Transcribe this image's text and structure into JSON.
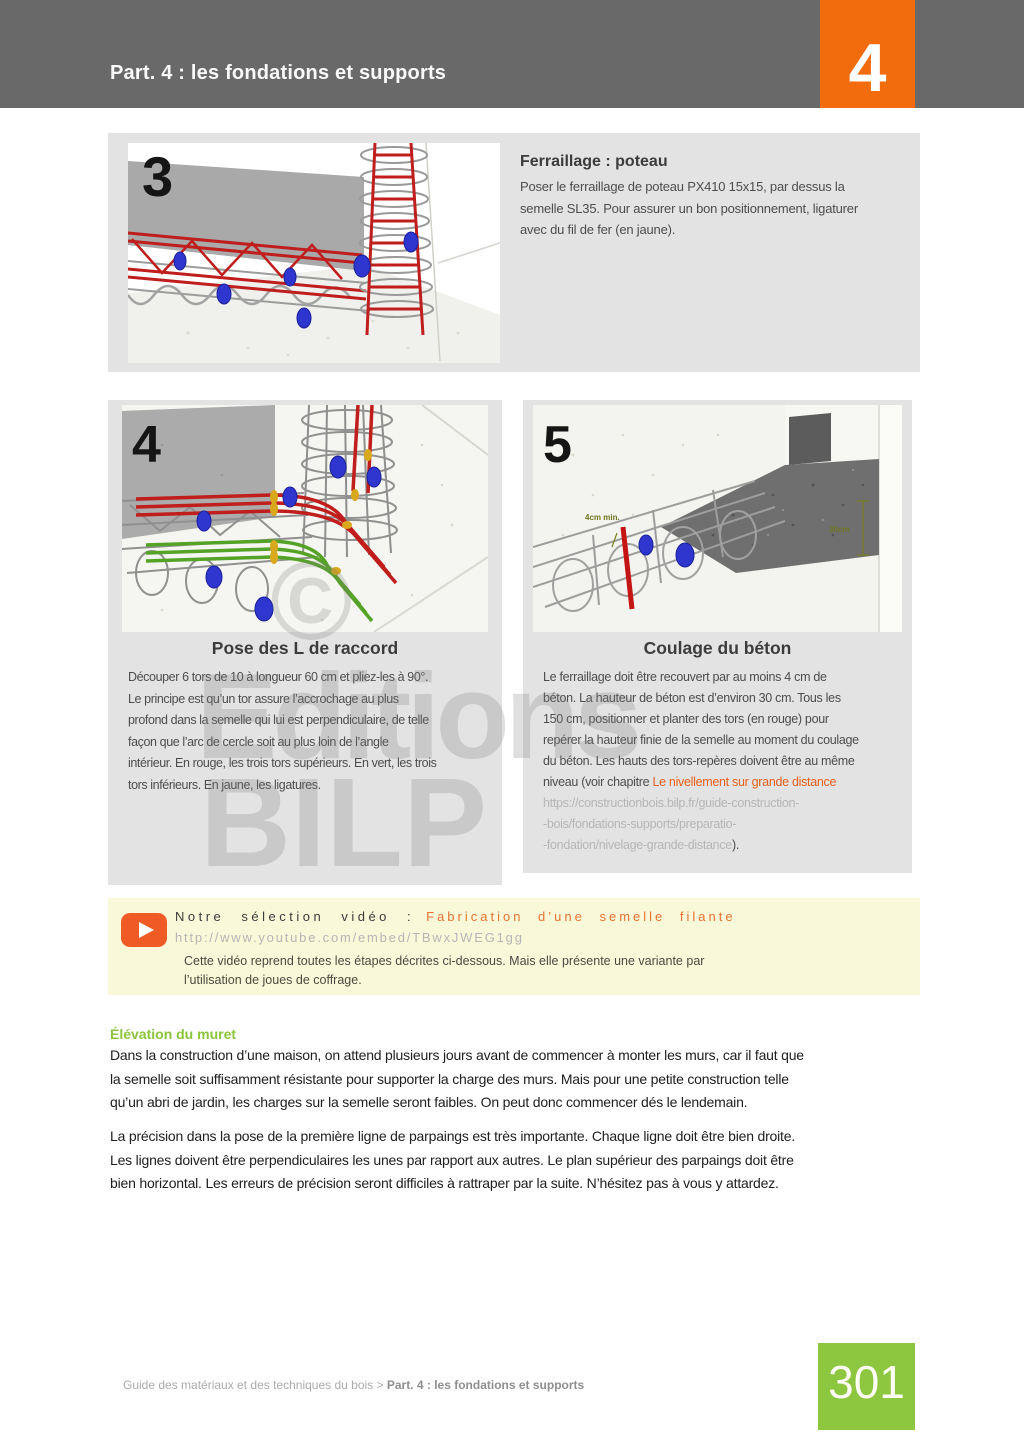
{
  "header": {
    "title": "Part. 4 : les fondations et supports",
    "chapter_number": "4"
  },
  "watermark": {
    "copyright": "©",
    "line1": "Editions",
    "line2": "BILP"
  },
  "step3": {
    "number": "3",
    "heading": "Ferraillage : poteau",
    "lines": [
      "Poser le ferraillage de poteau PX410 15x15, par dessus la",
      "semelle SL35. Pour assurer un bon positionnement, ligaturer",
      "avec du fil de fer (en jaune)."
    ]
  },
  "step4": {
    "number": "4",
    "caption": "Pose des L de raccord",
    "lines": [
      "Découper 6 tors de 10 à longueur 60 cm et pliez-les à 90°.",
      "Le principe est qu’un tor assure l’accrochage au plus",
      "profond dans la semelle qui lui est perpendiculaire, de telle",
      "façon que l’arc de cercle soit au plus loin de l’angle",
      "intérieur. En rouge, les trois tors supérieurs. En vert, les trois",
      "tors inférieurs. En jaune, les ligatures."
    ]
  },
  "step5": {
    "number": "5",
    "caption": "Coulage du béton",
    "annotation_4cm": "4cm min.",
    "annotation_30cm": "30cm",
    "lines": [
      "Le ferraillage doit être recouvert par au moins 4 cm de",
      "béton. La hauteur de béton est d’environ 30 cm. Tous les",
      "150 cm, positionner et planter des tors (en rouge) pour",
      "repérer la hauteur finie de la semelle au moment du coulage",
      "du béton. Les hauts des tors-repères doivent être au même"
    ],
    "link_prefix": "niveau (voir chapitre ",
    "link_text": "Le nivellement sur grande distance",
    "url_lines": [
      "https://constructionbois.bilp.fr/guide-construction-",
      "-bois/fondations-supports/preparatio-"
    ],
    "url_last": "-fondation/nivelage-grande-distance",
    "after_url": ")."
  },
  "video": {
    "label": "Notre sélection vidéo :",
    "title": "Fabrication d’une semelle filante",
    "url": "http://www.youtube.com/embed/TBwxJWEG1gg",
    "desc": [
      "Cette vidéo reprend toutes les étapes décrites ci-dessous. Mais elle présente une variante par",
      "l’utilisation de joues de coffrage."
    ]
  },
  "elevation": {
    "heading": "Élévation du muret",
    "p1": [
      "Dans la construction d’une maison, on attend plusieurs jours avant de commencer à monter les murs, car il faut que",
      "la semelle soit suffisamment résistante pour supporter la charge des murs. Mais pour une petite construction telle",
      "qu’un abri de jardin, les charges sur la semelle seront faibles. On peut donc commencer dés le lendemain."
    ],
    "p2": [
      "La précision dans la pose de la première ligne de parpaings est très importante. Chaque ligne doit être bien droite.",
      "Les lignes doivent être perpendiculaires les unes par rapport aux autres. Le plan supérieur des parpaings doit être",
      "bien horizontal. Les erreurs de précision seront difficiles à rattraper par la suite. N’hésitez pas à vous y attardez."
    ]
  },
  "footer": {
    "breadcrumb_prefix": "Guide des matériaux et des techniques du bois > ",
    "breadcrumb_current": "Part. 4 : les fondations et supports",
    "page_number": "301"
  },
  "colors": {
    "header_gray": "#696969",
    "accent_orange": "#f26c0d",
    "block_gray": "#e3e3e3",
    "link_orange": "#e8611c",
    "heading_green": "#8cc43c",
    "page_green": "#8dc63f",
    "video_bg": "#f9f8d8"
  }
}
